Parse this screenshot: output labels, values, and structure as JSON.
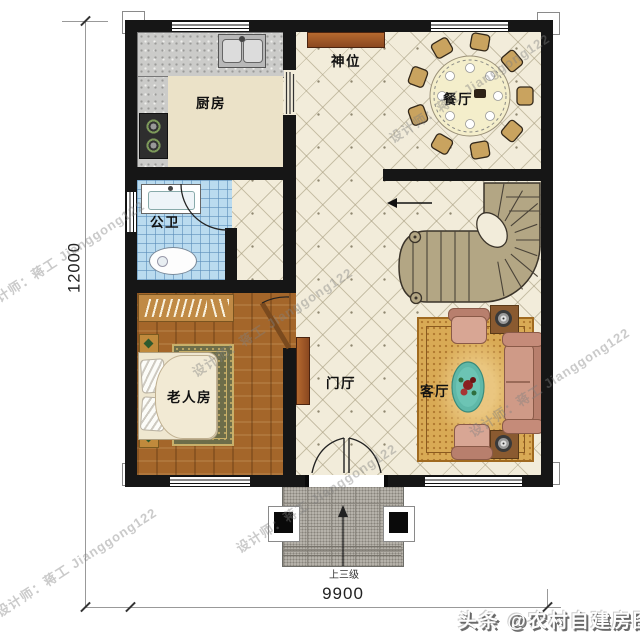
{
  "plan": {
    "rooms": [
      {
        "name": "kitchen",
        "label": "厨房"
      },
      {
        "name": "shrine",
        "label": "神位"
      },
      {
        "name": "dining",
        "label": "餐厅"
      },
      {
        "name": "bathroom",
        "label": "公卫"
      },
      {
        "name": "elder-bedroom",
        "label": "老人房"
      },
      {
        "name": "foyer",
        "label": "门厅"
      },
      {
        "name": "living",
        "label": "客厅"
      }
    ],
    "dimensions": {
      "height": "12000",
      "width": "9900"
    },
    "entry_note": "上三级"
  },
  "watermarks": {
    "designer": "设计师：蒋工 Jianggong122",
    "credit": "头条 @农村自建房图纸"
  },
  "colors": {
    "wall": "#161616",
    "floor_tile": "#f2ecda",
    "wood_floor": "#a4662a",
    "bath_tile": "#badbef",
    "stair": "#b3a684",
    "sofa": "#c58b79",
    "rug": "#d9aa55",
    "cabinet": "#a0522d"
  }
}
